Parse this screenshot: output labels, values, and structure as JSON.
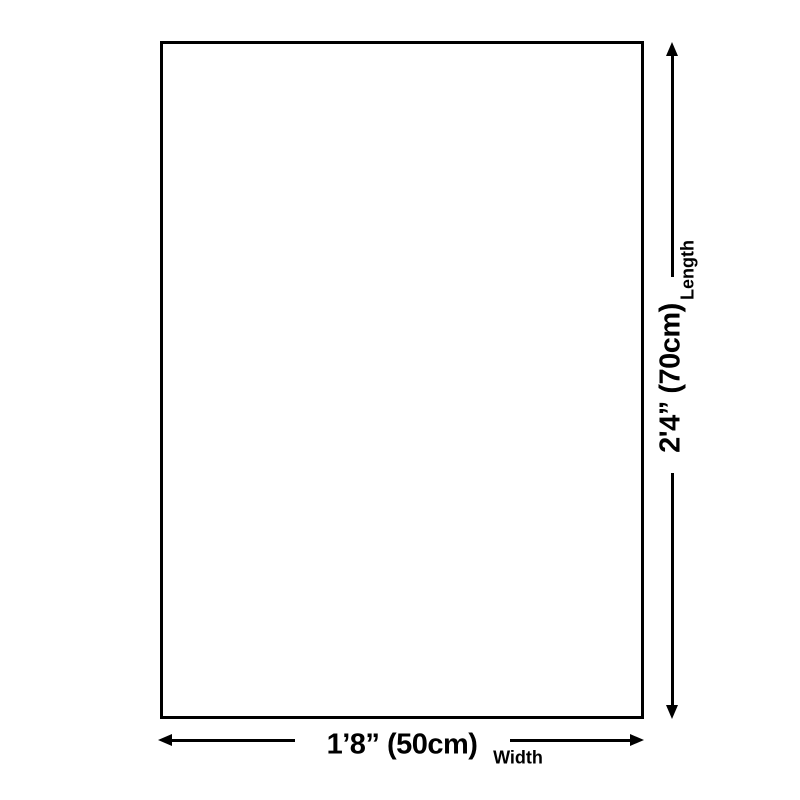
{
  "diagram": {
    "background_color": "#ffffff",
    "line_color": "#000000",
    "product": {
      "shape": "rectangle"
    },
    "length_dimension": {
      "value": "2'4” (70cm)",
      "label": "Length"
    },
    "width_dimension": {
      "value": "1’8” (50cm)",
      "label": "Width"
    }
  }
}
